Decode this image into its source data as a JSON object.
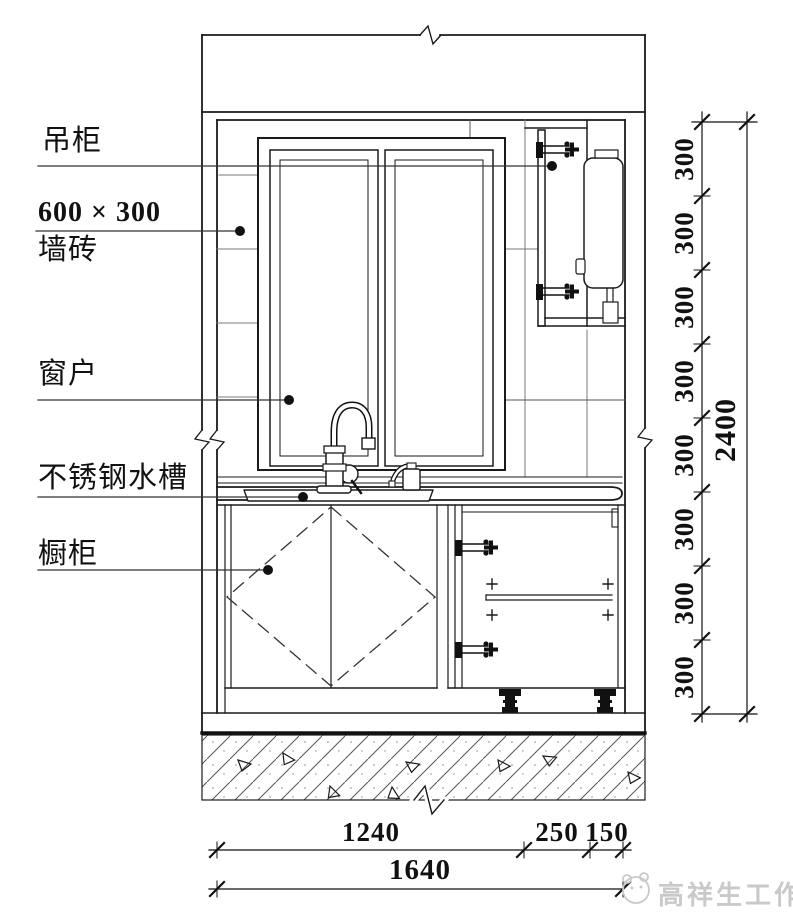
{
  "drawing_title": "kitchen-elevation-section",
  "labels": {
    "hanging_cabinet": "吊柜",
    "wall_tile_size": "600 × 300",
    "wall_tile": "墙砖",
    "window": "窗户",
    "sink": "不锈钢水槽",
    "base_cabinet": "橱柜"
  },
  "dimensions": {
    "right_chain": [
      "300",
      "300",
      "300",
      "300",
      "300",
      "300",
      "300",
      "300"
    ],
    "right_total": "2400",
    "bottom_chain": [
      "1240",
      "250",
      "150"
    ],
    "bottom_total": "1640"
  },
  "watermark": {
    "studio_name": "高祥生工作室"
  },
  "colors": {
    "line": "#1a1a1a",
    "tile_line": "#7a7a7a",
    "dashed_door_swing": "#333333",
    "watermark": "#c9c9c9",
    "background": "#ffffff"
  }
}
